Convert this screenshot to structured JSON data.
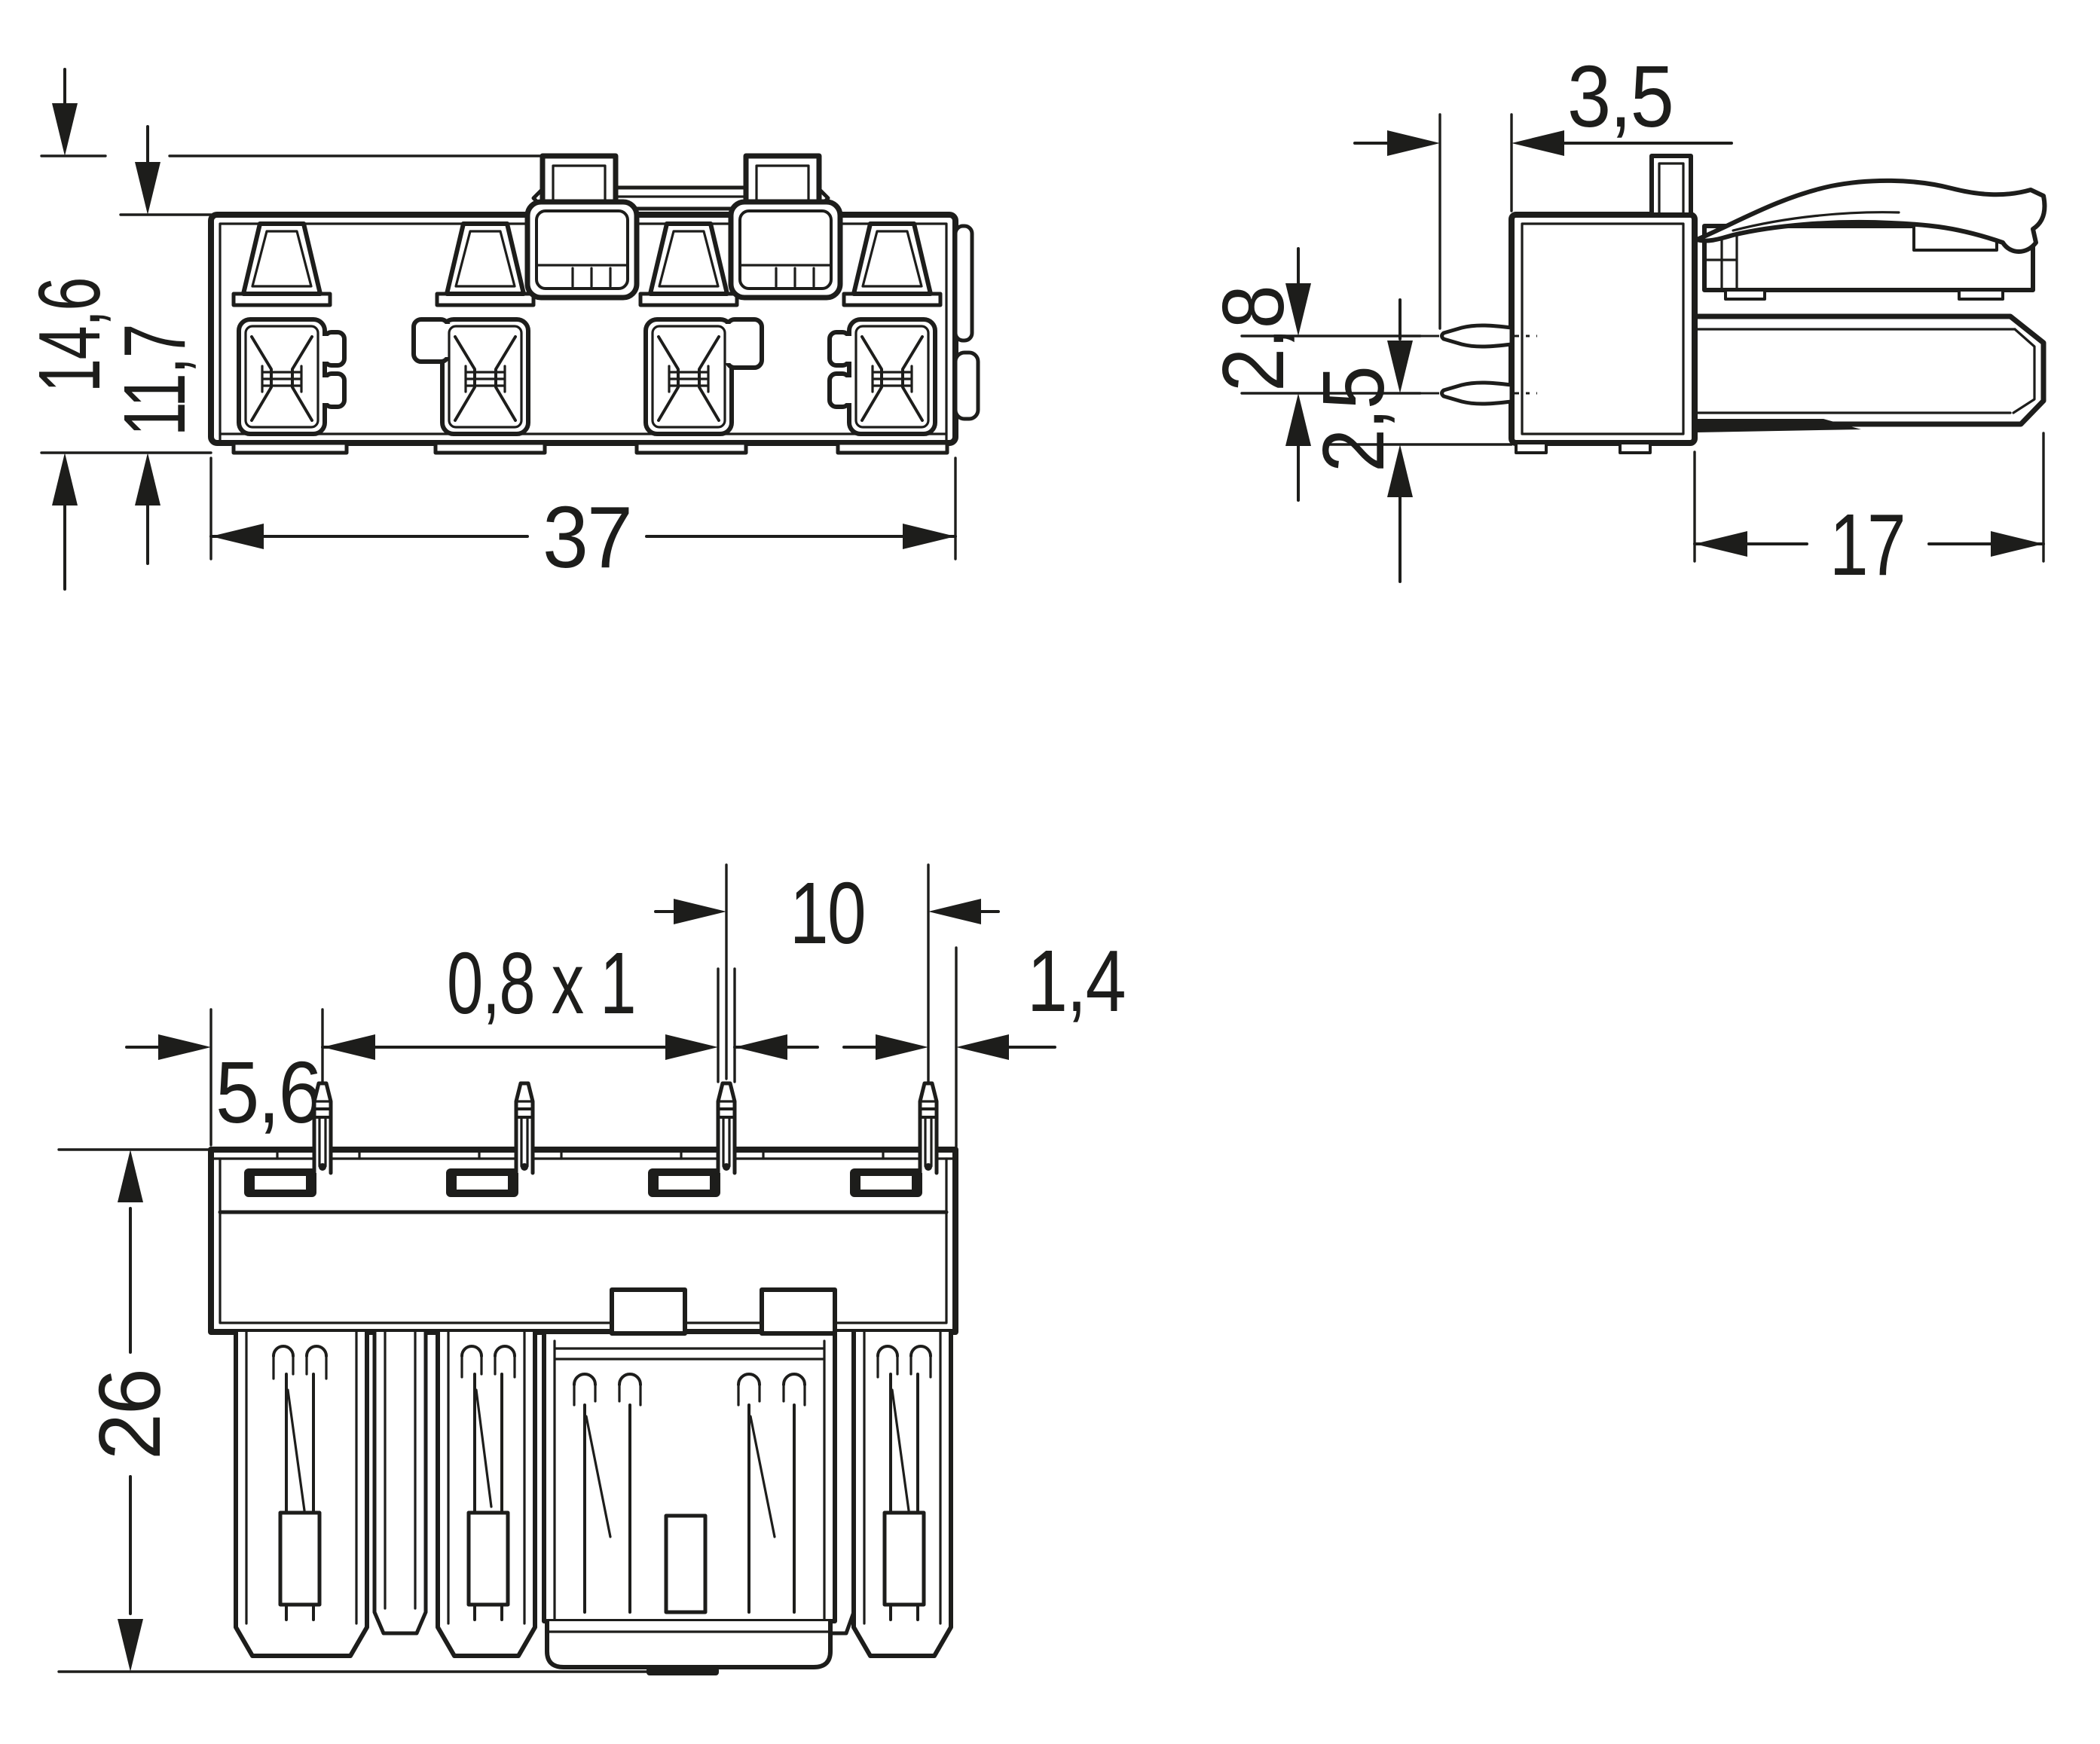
{
  "drawing": {
    "type": "technical-dimension-drawing",
    "subject": "4-pole PCB connector, three orthographic views",
    "line_color": "#1d1d1b",
    "background_color": "#ffffff",
    "units_implied": "mm",
    "dimensions": {
      "front": {
        "total_height": "14,6",
        "body_height": "11,7",
        "width": "37"
      },
      "side": {
        "pin_protrusion": "3,5",
        "pin_row_spacing": "2,8",
        "pin_to_bottom": "2,5",
        "depth": "17"
      },
      "bottom": {
        "pole_pitch": "10",
        "pin_cross_section": "0,8 x 1",
        "pin_to_edge": "1,4",
        "edge_to_first_pin": "5,6",
        "overall_height": "26"
      }
    }
  }
}
